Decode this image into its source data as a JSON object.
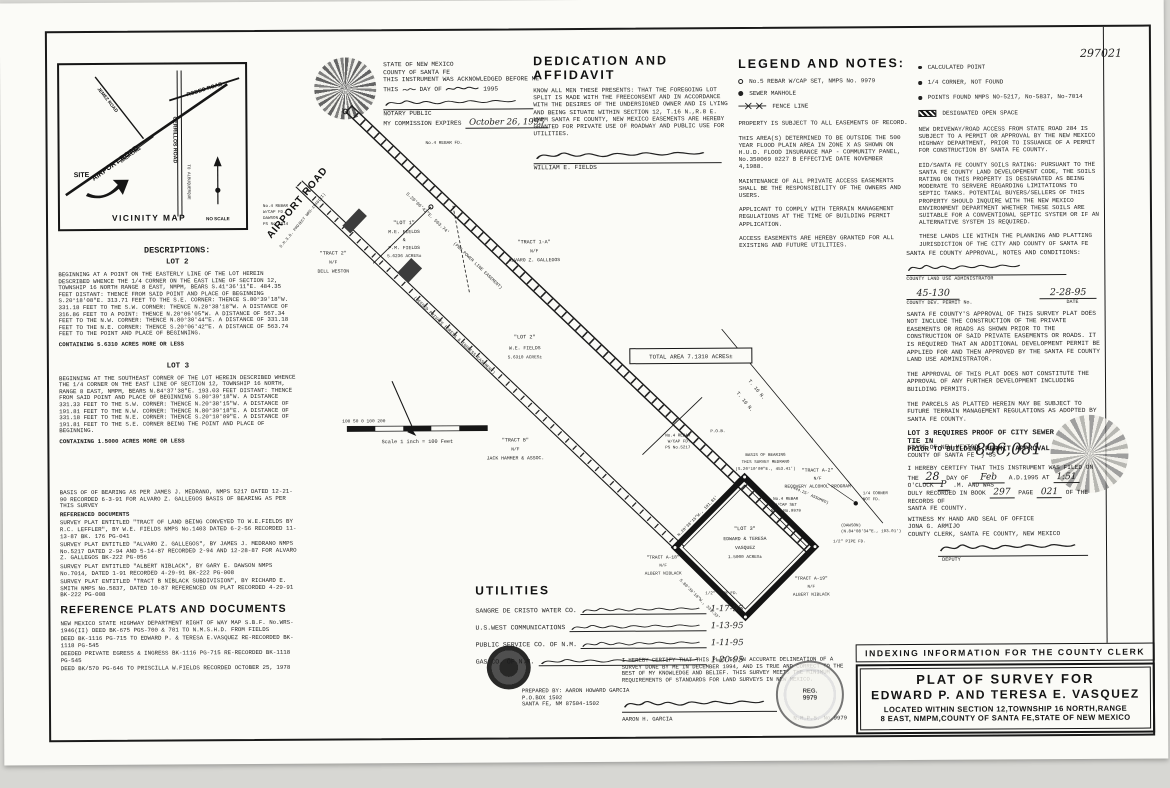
{
  "scan": {
    "doc_number_hw": "297021",
    "recording_number_hw": "896,081"
  },
  "vicinity": {
    "title": "VICINITY MAP",
    "no_scale": "NO SCALE",
    "site": "SITE",
    "airport": "AIRPORT ROAD",
    "rodeo": "RODEO ROAD",
    "cerrillos": "CERRILLOS ROAD",
    "to_abq": "TO ALBUQUERQUE",
    "jemez": "JEMEZ ROAD",
    "linda": "LINDA LANE"
  },
  "notary": {
    "line1": "STATE OF NEW MEXICO",
    "line2": "COUNTY OF SANTA FE",
    "line3": "THIS INSTRUMENT WAS ACKNOWLEDGED BEFORE ME",
    "line4a": "THIS",
    "line4b": "DAY OF",
    "line4c": "1995",
    "notary_public": "NOTARY PUBLIC",
    "expires_label": "MY COMMISSION EXPIRES",
    "expires_date": "October 26, 1995"
  },
  "dedication": {
    "title": "DEDICATION AND AFFIDAVIT",
    "body": "KNOW ALL MEN THESE PRESENTS: THAT THE FOREGOING LOT SPLIT IS MADE WITH THE FREECONSENT AND IN ACCORDANCE WITH THE DESIRES OF THE UNDERSIGNED OWNER AND IS LYING AND BEING SITUATE WITHIN SECTION 12, T.16 N.,R.8 E. NMPM SANTA FE COUNTY, NEW MEXICO EASEMENTS ARE HEREBY GRANTED FOR PRIVATE USE OF ROADWAY AND PUBLIC USE FOR UTILITIES.",
    "signer": "WILLIAM E. FIELDS"
  },
  "legend": {
    "title": "LEGEND AND NOTES:",
    "item1": "No.5 REBAR W/CAP SET, NMPS No. 9979",
    "item2": "SEWER MANHOLE",
    "item3": "FENCE LINE",
    "notes": [
      "PROPERTY IS SUBJECT TO ALL EASEMENTS OF RECORD.",
      "THIS AREA(S) DETERMINED TO BE OUTSIDE THE 500 YEAR FLOOD PLAIN AREA IN ZONE X AS SHOWN ON H.U.D. FLOOD INSURANCE MAP - COMMUNITY PANEL, No.350069 0227 B EFFECTIVE DATE NOVEMBER 4,1988.",
      "MAINTENANCE OF ALL PRIVATE ACCESS EASEMENTS SHALL BE THE RESPONSIBILITY OF THE OWNERS AND USERS.",
      "APPLICANT TO COMPLY WITH TERRAIN MANAGEMENT REGULATIONS AT THE TIME OF BUILDING PERMIT APPLICATION.",
      "ACCESS EASEMENTS ARE HEREBY GRANTED FOR ALL EXISTING AND FUTURE UTILITIES."
    ]
  },
  "legend_right": {
    "item1": "CALCULATED POINT",
    "item2": "1/4 CORNER, NOT FOUND",
    "item3": "POINTS FOUND NMPS NO-5217, No-5837, No-7014",
    "item4": "DESIGNATED OPEN SPACE",
    "notes": [
      "NEW DRIVEWAY/ROAD ACCESS FROM STATE ROAD 284 IS SUBJECT TO A PERMIT OR APPROVAL BY THE NEW MEXICO HIGHWAY DEPARTMENT, PRIOR TO ISSUANCE OF A PERMIT FOR CONSTRUCTION BY SANTA FE COUNTY.",
      "EID/SANTA FE COUNTY SOILS RATING: PURSUANT TO THE SANTA FE COUNTY LAND DEVELOPEMENT CODE, THE SOILS RATING ON THIS PROPERTY IS DESIGNATED AS BEING MODERATE TO SERVERE REGARDING LIMITATIONS TO SEPTIC TANKS. POTENTIAL BUYERS/SELLERS OF THIS PROPERTY SHOULD INQUIRE WITH THE NEW MEXICO ENVIRONMENT DEPARTMENT WHETHER THESE SOILS ARE SUITABLE FOR A CONVENTIONAL SEPTIC SYSTEM OR IF AN ALTERNATIVE SYSTEM IS REQUIRED.",
      "THESE LANDS LIE WITHIN THE PLANNING AND PLATTING JURISDICTION OF THE CITY AND COUNTY OF SANTA FE"
    ]
  },
  "approval": {
    "title": "SANTA FE COUNTY APPROVAL, NOTES AND CONDITIONS:",
    "admin_label": "COUNTY LAND USE ADMINISTRATOR",
    "permit_no": "45-130",
    "permit_label": "COUNTY DEV. PERMIT No.",
    "date": "2-28-95",
    "date_label": "DATE",
    "paragraphs": [
      "SANTA FE COUNTY'S APPROVAL OF THIS SURVEY PLAT DOES NOT INCLUDE THE CONSTRUCTION OF THE PRIVATE EASEMENTS OR ROADS AS SHOWN PRIOR TO THE CONSTRUCTION OF SAID PRIVATE EASEMENTS OR ROADS. IT IS REQUIRED THAT AN ADDITIONAL DEVELOPMENT PERMIT BE APPLIED FOR AND THEN APPROVED BY THE SANTA FE COUNTY LAND USE ADMINISTRATOR.",
      "THE APPROVAL OF THIS PLAT DOES NOT CONSTITUTE THE APPROVAL OF ANY FURTHER DEVELOPMENT INCLUDING BUILDING PERMITS.",
      "THE PARCELS AS PLATTED HEREIN MAY BE SUBJECT TO FUTURE TERRAIN MANAGEMENT REGULATIONS AS ADOPTED BY SANTA FE COUNTY."
    ],
    "bold_note_1": "LOT 3 REQUIRES PROOF OF CITY SEWER TIE IN",
    "bold_note_2": "PRIOR TO BUILDING PERMIT APPROVAL"
  },
  "recording": {
    "state": "STATE OF NEW MEXICO",
    "county": "COUNTY OF SANTA FE",
    "ss": "SS",
    "cert1": "I HEREBY CERTIFY THAT THIS INSTRUMENT WAS FILED ON THE",
    "hw_day": "28",
    "cert2": "DAY OF",
    "hw_month": "Feb",
    "cert3": "A.D.1995 AT",
    "hw_time": "1:51",
    "cert4": "O'CLOCK",
    "hw_m": "P",
    "cert5": ".M. AND WAS",
    "cert6": "DULY RECORDED IN BOOK",
    "hw_book": "297",
    "cert7": "PAGE",
    "hw_page": "021",
    "cert8": "OF THE RECORDS OF",
    "cert9": "SANTA FE COUNTY.",
    "witness": "WITNESS MY HAND AND SEAL OF OFFICE",
    "clerk_name": "JONA G. ARMIJO",
    "clerk_title": "COUNTY CLERK, SANTA FE COUNTY, NEW MEXICO",
    "deputy_label": "DEPUTY"
  },
  "descriptions": {
    "title": "DESCRIPTIONS:",
    "lot2_title": "LOT 2",
    "lot2_body": "BEGINNING AT A POINT ON THE EASTERLY LINE OF THE LOT HEREIN DESCRIBED WHENCE THE 1/4 CORNER ON THE EAST LINE OF SECTION 12, TOWNSHIP 16 NORTH RANGE 8 EAST, NMPM, BEARS S.41°36'11\"E. 484.35 FEET DISTANT: THENCE FROM SAID POINT AND PLACE OF BEGINNING S.20°18'08\"E. 313.71 FEET TO THE S.E. CORNER: THENCE S.80°39'18\"W. 331.18 FEET TO THE S.W. CORNER: THENCE N.20°38'18\"W. A DISTANCE OF 316.86 FEET TO A POINT: THENCE N.20°06'05\"W. A DISTANCE OF 567.34 FEET TO THE N.W. CORNER: THENCE N.80°30'44\"E. A DISTANCE OF 331.18 FEET TO THE N.E. CORNER: THENCE S.20°06'42\"E. A DISTANCE OF 563.74 FEET TO THE POINT AND PLACE OF BEGINNING.",
    "lot2_area": "CONTAINING 5.6310 ACRES MORE OR LESS",
    "lot3_title": "LOT 3",
    "lot3_body": "BEGINNING AT THE SOUTHEAST CORNER OF THE LOT HEREIN DESCRIBED WHENCE THE 1/4 CORNER ON THE EAST LINE OF SECTION 12, TOWNSHIP 16 NORTH, RANGE 8 EAST, NMPM, BEARS N.84°37'38\"E. 193.03 FEET DISTANT: THENCE FROM SAID POINT AND PLACE OF BEGINNING S.80°39'18\"W. A DISTANCE 331.33 FEET TO THE S.W. CORNER: THENCE N.20°38'15\"W. A DISTANCE OF 191.81 FEET TO THE N.W. CORNER: THENCE N.80°39'18\"E. A DISTANCE OF 331.18 FEET TO THE N.E. CORNER: THENCE S.20°10'09\"E. A DISTANCE OF 191.81 FEET TO THE S.E. CORNER BEING THE POINT AND PLACE OF BEGINNING.",
    "lot3_area": "CONTAINING 1.5000 ACRES MORE OR LESS"
  },
  "reference": {
    "title": "REFERENCE PLATS AND DOCUMENTS",
    "items_above": [
      "BASIS OF OF BEARING AS PER JAMES J. MEDRANO, NMPS 5217 DATED 12-21-90 RECORDED 6-3-91 FOR ALVARO Z. GALLEGOS BASIS OF BEARING AS PER THIS SURVEY",
      "REFERENCED DOCUMENTS",
      "SURVEY PLAT ENTITLED \"TRACT OF LAND BEING CONVEYED TO W.E.FIELDS BY R.C. LEFFLER\", BY W.E. FIELDS NMPS No.1403  DATED 6-2-56 RECORDED 11-13-87  BK. 176 PG-041",
      "SURVEY PLAT ENTITLED \"ALVARO Z. GALLEGOS\", BY JAMES J. MEDRANO NMPS No.5217  DATED 2-94 AND 5-14-87 RECORDED 2-94 AND 12-28-87 FOR ALVARO Z. GALLEGOS BK-222 PG-056",
      "SURVEY PLAT ENTITLED \"ALBERT NIBLACK\", BY GARY E. DAWSON NMPS No.7014, DATED 1-91 RECORDED 4-29-91 BK-222 PG-008",
      "SURVEY PLAT ENTITLED \"TRACT B NIBLACK SUBDIVISION\", BY RICHARD E. SMITH NMPS No.5837, DATED 10-87 REFERENCED ON PLAT RECORDED 4-29-91 BK-222 PG-008"
    ],
    "items_below": [
      "NEW MEXICO STATE HIGHWAY DEPARTMENT RIGHT OF WAY MAP S.B.F. No.WRS-1946(II) DEED BK-675 PGS-700 & 701 TO N.M.S.H.D. FROM FIELDS",
      "DEED BK-1116 PG-715 TO EDWARD P. & TERESA E.VASQUEZ RE-RECORDED BK-1118 PG-545",
      "DEEDED PRIVATE EGRESS & INGRESS BK-1116 PG-715 RE-RECORDED BK-1118 PG-545",
      "DEED BK/570 PG-646 TO PRISCILLA W.FIELDS RECORDED OCTOBER 25, 1978"
    ]
  },
  "utilities": {
    "title": "UTILITIES",
    "rows": [
      {
        "name": "SANGRE DE CRISTO WATER CO.",
        "date": "1-17-95"
      },
      {
        "name": "U.S.WEST COMMUNICATIONS",
        "date": "1-13-95"
      },
      {
        "name": "PUBLIC SERVICE CO. OF N.M.",
        "date": "1-11-95"
      },
      {
        "name": "GAS CO. OF N.M.",
        "date": "1-20-95"
      }
    ]
  },
  "certification": {
    "body": "I HEREBY CERTIFY THAT THIS PLAT IS AN ACCURATE DELINEATION OF A SURVEY DONE BY ME IN DECEMBER 1994, AND IS TRUE AND CORRECT TO THE BEST OF MY KNOWLEDGE AND BELIEF. THIS SURVEY MEETS THE MINIMUM REQUIREMENTS OF STANDARDS FOR LAND SURVEYS IN NEW MEXICO.",
    "prepared": [
      "PREPARED BY: AARON HOWARD GARCIA",
      "P.O.BOX 1502",
      "SANTA FE, NM 87504-1502"
    ],
    "surveyor": "AARON H. GARCIA",
    "license": "N.M.P.S. No.9979",
    "seal_line1": "REG.",
    "seal_line2": "9979"
  },
  "title_block": {
    "indexing": "INDEXING INFORMATION FOR THE COUNTY CLERK",
    "line1": "PLAT OF SURVEY FOR",
    "line2": "EDWARD P. AND TERESA E. VASQUEZ",
    "line3": "LOCATED WITHIN SECTION 12,TOWNSHIP 16 NORTH,RANGE",
    "line4": "8 EAST, NMPM,COUNTY OF SANTA FE,STATE OF NEW MEXICO"
  },
  "drawing": {
    "road": "AIRPORT ROAD",
    "road_sub": "S.H.S.D. PROJECT WRS-1946(II)",
    "rebar_fd": "No.4 REBAR FD.",
    "bearing_road": "S.20°06'42\"E.  563.74'",
    "pnm": "(PNM POWER LINE EASEMENT)",
    "egress": "(DEEDED PRIVATE EGRESS & INGRESS EASEMENT)",
    "lot1": [
      "\"LOT 1\"",
      "M.E. FIELDS",
      "&",
      "P.M. FIELDS",
      "5.6236 ACRES±"
    ],
    "tract1a": [
      "\"TRACT 1-A\"",
      "N/F",
      "ALVARO Z. GALLEGOS"
    ],
    "tract2": [
      "\"TRACT 2\"",
      "N/F",
      "DELL WESTON"
    ],
    "lot2": [
      "\"LOT 2\"",
      "W.E. FIELDS",
      "5.6310 ACRES±"
    ],
    "tractb": [
      "\"TRACT B\"",
      "N/F",
      "JACK HAMMER & ASSOC."
    ],
    "total": "TOTAL AREA 7.1310 ACRES±",
    "t16a": "T. 16 N.",
    "t16b": "T. 16 N.",
    "recovery": [
      "\"TRACT A-2\"",
      "N/F",
      "RECOVERY ALCOHOL PROGRAM"
    ],
    "basis": [
      "BASIS OF BEARING",
      "THIS SURVEY MEDRANO",
      "(S.20°10'09\"E., 453.41')"
    ],
    "rebar_set": [
      "No.4 REBAR",
      "W/CAP SET",
      "NMPS No.9979"
    ],
    "quarter": [
      "1/4 CORNER",
      "NOT FD."
    ],
    "dawson": [
      "(DAWSON)",
      "(N.84°08'34\"E., 193.01')"
    ],
    "pipe": "1/2\" PIPE FD.",
    "assumed": "(444.25' ASSUMED)",
    "lot3": [
      "\"LOT 3\"",
      "EDWARD & TERESA",
      "VASQUEZ",
      "1.5000 ACRES±"
    ],
    "tracta19": [
      "\"TRACT A-19\"",
      "N/F",
      "ALBERT NIBLACK"
    ],
    "tracta18": [
      "\"TRACT A-18\"",
      "N/F",
      "ALBERT NIBLACK"
    ],
    "rebar5217": [
      "No.4 REBAR",
      "W/CAP FD.",
      "PS No.5217"
    ],
    "pob": "P.O.B.",
    "rebar_dawson": [
      "No.4 REBAR",
      "W/CAP FD.",
      "DAWSON",
      "PS No.7014"
    ],
    "edge_sw": "S.80°39'18\"W., 331.33'",
    "edge_nw": "N.20°38'15\"W., 191.81'",
    "scale_ticks": "100     50      0              100             200",
    "scale_label": "Scale 1 inch = 100 Feet"
  }
}
